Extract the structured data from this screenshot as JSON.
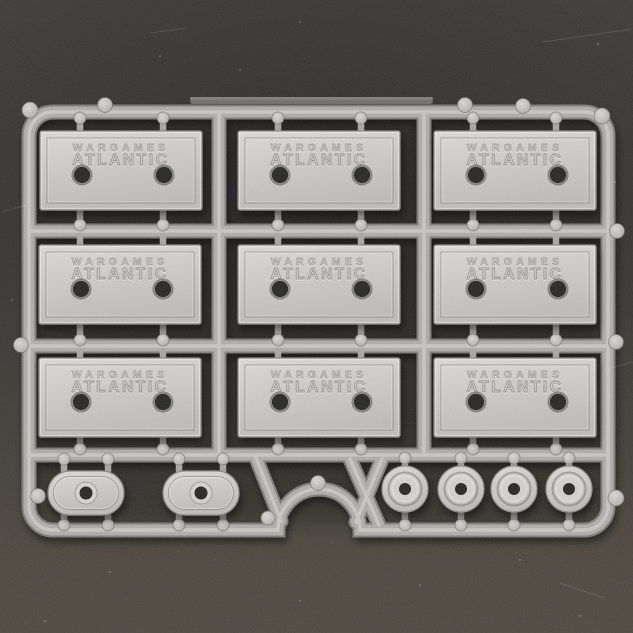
{
  "scene": {
    "type": "photograph",
    "subject": "plastic-model-sprue-of-miniature-bases",
    "brand": {
      "line1": "WARGAMES",
      "line2": "ATLANTIC"
    },
    "bases": {
      "rectangular_count": 9,
      "oval_count": 2,
      "round_count": 4
    },
    "colors": {
      "sprue_plastic": "#adacaa",
      "base_plate": "#cbcac7",
      "base_hole": "#2b2927",
      "backdrop_top": "#3d3b38",
      "backdrop_bottom": "#4f4b43"
    }
  }
}
